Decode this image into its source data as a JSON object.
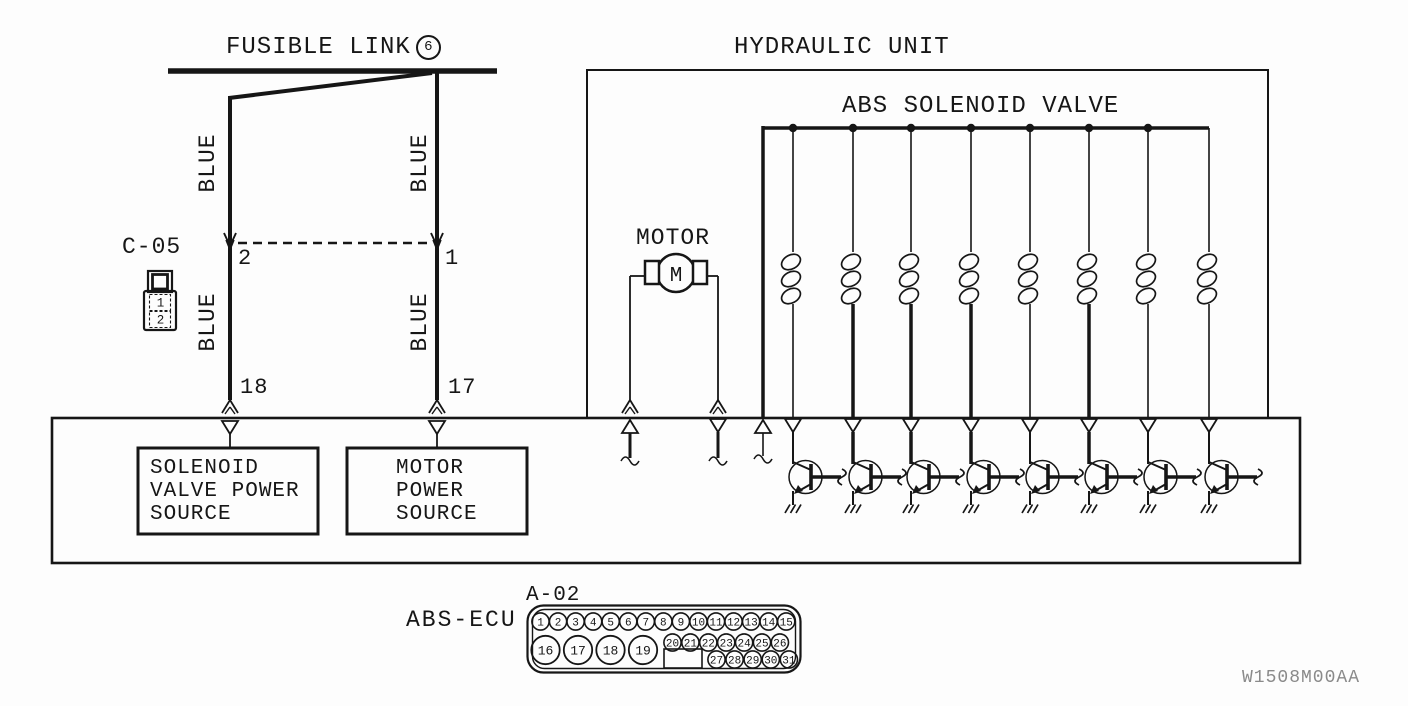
{
  "fusible_link": {
    "label": "FUSIBLE LINK",
    "number": "6"
  },
  "hydraulic_unit": {
    "label": "HYDRAULIC UNIT"
  },
  "abs_solenoid_valve": {
    "label": "ABS SOLENOID VALVE",
    "solenoid_count": 8
  },
  "motor": {
    "label": "MOTOR",
    "symbol": "M"
  },
  "connector_c05": {
    "label": "C-05",
    "pins": [
      "1",
      "2"
    ]
  },
  "wires": {
    "upper_left": "BLUE",
    "upper_right": "BLUE",
    "lower_left": "BLUE",
    "lower_right": "BLUE"
  },
  "terminals": {
    "c05_left": "2",
    "c05_right": "1",
    "ecu_left": "18",
    "ecu_right": "17"
  },
  "ecu": {
    "label": "ABS-ECU",
    "connector_label": "A-02",
    "solenoid_power_lines": [
      "SOLENOID",
      "VALVE POWER",
      "SOURCE"
    ],
    "motor_power_lines": [
      "MOTOR",
      "POWER",
      "SOURCE"
    ],
    "connector_pins": {
      "row1": [
        "1",
        "2",
        "3",
        "4",
        "5",
        "6",
        "7",
        "8",
        "9",
        "10",
        "11",
        "12",
        "13",
        "14",
        "15"
      ],
      "large": [
        "16",
        "17",
        "18",
        "19"
      ],
      "row2": [
        "20",
        "21",
        "22",
        "23",
        "24",
        "25",
        "26"
      ],
      "row3": [
        "27",
        "28",
        "29",
        "30",
        "31"
      ]
    }
  },
  "watermark": "W1508M00AA",
  "colors": {
    "line": "#161616",
    "background": "#fdfdfd",
    "watermark": "#8a8a8a"
  }
}
